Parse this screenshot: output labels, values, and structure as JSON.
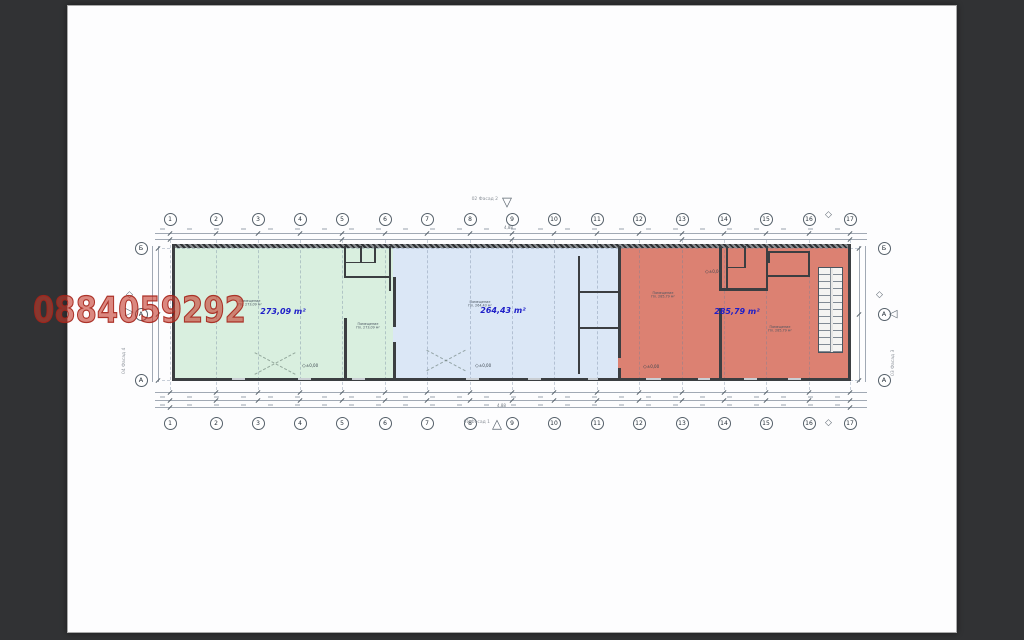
{
  "canvas": {
    "background": "#313234",
    "page_color": "#fdfdfe"
  },
  "watermark": {
    "text": "0884059292",
    "color": "#c43a2c"
  },
  "plan": {
    "grid_columns": [
      "1",
      "2",
      "3",
      "4",
      "5",
      "6",
      "7",
      "8",
      "9",
      "10",
      "11",
      "12",
      "13",
      "14",
      "15",
      "16",
      "17"
    ],
    "row_top": "Б",
    "row_bottom": "А",
    "facade_row_letter": "А",
    "area_label_color": "#1e1ec8",
    "zones": [
      {
        "name": "green",
        "fill": "#d9efdf",
        "area_label": "273,09 m²",
        "rooms": [
          {
            "title": "Помещение",
            "area": "Пл. 273,09 м²"
          },
          {
            "title": "Помещение",
            "area": "Пл. 273,09 м²"
          }
        ]
      },
      {
        "name": "blue",
        "fill": "#dbe7f6",
        "area_label": "264,43 m²",
        "rooms": [
          {
            "title": "Помещение",
            "area": "Пл. 264,43 м²"
          }
        ]
      },
      {
        "name": "red",
        "fill": "#dc8172",
        "area_label": "285,79 m²",
        "rooms": [
          {
            "title": "Помещение",
            "area": "Пл. 285,79 м²"
          },
          {
            "title": "Помещение",
            "area": "Пл. 285,79 м²"
          }
        ]
      }
    ],
    "facades": {
      "top": "02 Фасад 2",
      "bottom": "01 Фасад 1",
      "left": "04 Фасад 4",
      "right": "03 Фасад 3"
    },
    "level_label": "±0,00",
    "dim_value_top": "4,88",
    "dim_value_bottom": "4,88"
  }
}
